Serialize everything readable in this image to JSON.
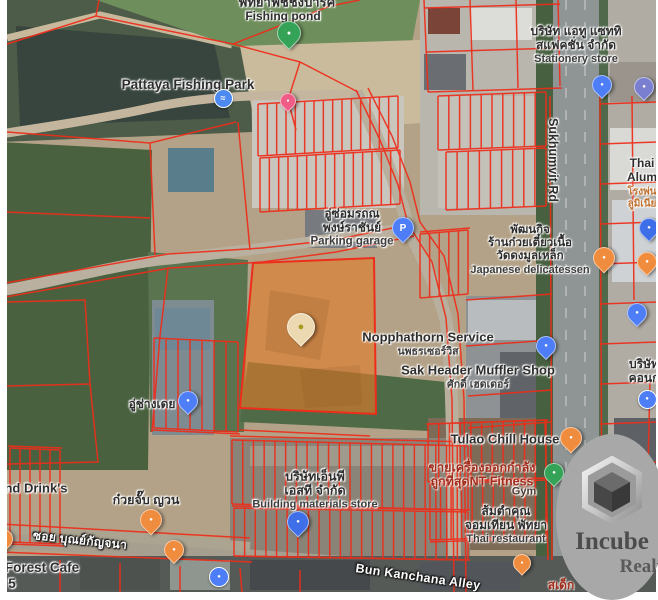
{
  "watermark": {
    "brand": "Incube",
    "division": "Realty"
  },
  "colors": {
    "cadastral_line": "#ee2d1a",
    "parcel_highlight": "#e07a29",
    "watermark_bg": "#a8a8a8",
    "poi_label": "#2e2e2e",
    "road_label": "#fdfdfd",
    "red_label": "#a02c1e"
  },
  "map": {
    "labels": [
      {
        "name": "fishing-park-thai",
        "x": 287,
        "y": 3,
        "style": "poi",
        "lines": [
          {
            "t": "พัทยาฟิชชิ่งปาร์ค",
            "s": 13
          }
        ]
      },
      {
        "name": "fishing-pond",
        "x": 283,
        "y": 17,
        "style": "poi",
        "lines": [
          {
            "t": "Fishing pond",
            "s": 12
          }
        ]
      },
      {
        "name": "pattaya-fishing-park",
        "x": 188,
        "y": 85,
        "style": "poi",
        "lines": [
          {
            "t": "Pattaya Fishing Park",
            "s": 13.5
          }
        ]
      },
      {
        "name": "stationery-store",
        "x": 576,
        "y": 45,
        "style": "poi",
        "lines": [
          {
            "t": "บริษัท แอทู แซททิ",
            "s": 12
          },
          {
            "t": "สแฟคชั่น จำกัด",
            "s": 12
          },
          {
            "t": "Stationery store",
            "s": 11,
            "c": "#3c3c3c"
          }
        ]
      },
      {
        "name": "sukhumvit-rd",
        "x": 553,
        "y": 160,
        "style": "poi",
        "rotate": 90,
        "lines": [
          {
            "t": "Sukhumvit Rd",
            "s": 12.5
          }
        ]
      },
      {
        "name": "thai-alum",
        "x": 642,
        "y": 171,
        "style": "poi",
        "lines": [
          {
            "t": "Thai",
            "s": 12
          },
          {
            "t": "Alum",
            "s": 12
          }
        ]
      },
      {
        "name": "thai-alum-sub",
        "x": 642,
        "y": 198,
        "style": "poi",
        "lines": [
          {
            "t": "โรงพ่น",
            "s": 10,
            "c": "#c0722f"
          },
          {
            "t": "ลูมิเนีย",
            "s": 10,
            "c": "#c0722f"
          }
        ]
      },
      {
        "name": "parking-garage",
        "x": 352,
        "y": 228,
        "style": "poi",
        "lines": [
          {
            "t": "อู่ซ่อมรถณ",
            "s": 12
          },
          {
            "t": "พงษ์ราชันย์",
            "s": 12
          },
          {
            "t": "Parking garage",
            "s": 11.5,
            "c": "#3c3c3c"
          }
        ]
      },
      {
        "name": "japanese-delicatessen",
        "x": 530,
        "y": 250,
        "style": "poi",
        "lines": [
          {
            "t": "พัฒนกิจ",
            "s": 11.5
          },
          {
            "t": "ร้านก๋วยเตี๋ยวเนื้อ",
            "s": 11.5
          },
          {
            "t": "วัดดงมูลเหล็ก",
            "s": 11.5
          },
          {
            "t": "Japanese delicatessen",
            "s": 11,
            "c": "#3c3c3c"
          }
        ]
      },
      {
        "name": "nopphathorn-service",
        "x": 428,
        "y": 344,
        "style": "poi",
        "lines": [
          {
            "t": "Nopphathorn Service",
            "s": 13
          },
          {
            "t": "นพธรเซอร์วิส",
            "s": 10.5,
            "c": "#3c3c3c"
          }
        ]
      },
      {
        "name": "sak-header-muffler-shop",
        "x": 478,
        "y": 377,
        "style": "poi",
        "lines": [
          {
            "t": "Sak Header Muffler Shop",
            "s": 13
          },
          {
            "t": "ศักดิ์ เฮดเดอร์",
            "s": 10.5,
            "c": "#3c3c3c"
          }
        ]
      },
      {
        "name": "u-chang-doei",
        "x": 152,
        "y": 405,
        "style": "poi",
        "lines": [
          {
            "t": "อู่ช่างเดย",
            "s": 12
          }
        ]
      },
      {
        "name": "tulao-chill-house",
        "x": 505,
        "y": 440,
        "style": "poi",
        "lines": [
          {
            "t": "Tulao Chill House",
            "s": 13
          }
        ]
      },
      {
        "name": "nt-fitness",
        "x": 482,
        "y": 475,
        "style": "red",
        "lines": [
          {
            "t": "ขายเครื่องออกกำลัง",
            "s": 12.5
          },
          {
            "t": "ถูกที่สุดNT Fitness",
            "s": 12.5
          }
        ]
      },
      {
        "name": "gym",
        "x": 524,
        "y": 492,
        "style": "poi",
        "lines": [
          {
            "t": "Gym",
            "s": 11,
            "c": "#4a3a32"
          }
        ]
      },
      {
        "name": "somtam-thai-restaurant",
        "x": 506,
        "y": 525,
        "style": "poi",
        "lines": [
          {
            "t": "ส้มตำคุณ",
            "s": 12
          },
          {
            "t": "จอมเทียน พัทยา",
            "s": 12
          },
          {
            "t": "Thai restaurant",
            "s": 11,
            "c": "#3c3c3c"
          }
        ]
      },
      {
        "name": "np-st-building-materials",
        "x": 315,
        "y": 490,
        "style": "poi",
        "lines": [
          {
            "t": "บริษัทเอ็นพี",
            "s": 12.5
          },
          {
            "t": "เอสที จำกัด",
            "s": 12.5
          },
          {
            "t": "Building materials store",
            "s": 11,
            "c": "#3c3c3c"
          }
        ]
      },
      {
        "name": "nd-drinks",
        "x": 36,
        "y": 489,
        "style": "poi",
        "lines": [
          {
            "t": "nd Drink's",
            "s": 13
          }
        ]
      },
      {
        "name": "kuai-jap-yuan",
        "x": 146,
        "y": 500,
        "style": "poi",
        "lines": [
          {
            "t": "ก๋วยจั๊บ ญวน",
            "s": 12.5
          }
        ]
      },
      {
        "name": "soi-bun-kanchana",
        "x": 80,
        "y": 541,
        "style": "road",
        "rotate": 6,
        "lines": [
          {
            "t": "ซอย บุณย์กัญจนา",
            "s": 12
          }
        ]
      },
      {
        "name": "forest-cafe",
        "x": 42,
        "y": 568,
        "style": "poi",
        "lines": [
          {
            "t": "Forest Cafe",
            "s": 13.5
          }
        ]
      },
      {
        "name": "forest-cafe-5",
        "x": 12,
        "y": 584,
        "style": "poi",
        "lines": [
          {
            "t": "5",
            "s": 13.5
          }
        ]
      },
      {
        "name": "bun-kanchana-alley",
        "x": 418,
        "y": 577,
        "style": "road",
        "rotate": 8,
        "lines": [
          {
            "t": "Bun Kanchana Alley",
            "s": 12.5
          }
        ]
      },
      {
        "name": "borisat-kon-partial",
        "x": 644,
        "y": 372,
        "style": "poi",
        "lines": [
          {
            "t": "บริษัท",
            "s": 12
          },
          {
            "t": "คอนก",
            "s": 12
          }
        ]
      },
      {
        "name": "sa-dek-partial",
        "x": 561,
        "y": 586,
        "style": "red",
        "lines": [
          {
            "t": "สเด็ก",
            "s": 12
          }
        ]
      }
    ],
    "pins": [
      {
        "name": "fishing-pond-pin",
        "kind": "drop",
        "x": 288,
        "y": 32,
        "size": 22,
        "color": "#34a257",
        "glyph": "●",
        "gs": 7
      },
      {
        "name": "park-pool-icon",
        "kind": "dot",
        "x": 222,
        "y": 97,
        "size": 17,
        "color": "#4d8af0",
        "glyph": "≈",
        "gs": 9
      },
      {
        "name": "park-entry-pin",
        "kind": "drop",
        "x": 287,
        "y": 100,
        "size": 14,
        "color": "#ef5c85",
        "glyph": "●",
        "gs": 5
      },
      {
        "name": "stationery-pin",
        "kind": "drop",
        "x": 601,
        "y": 84,
        "size": 18,
        "color": "#4d7ef7",
        "glyph": "●",
        "gs": 6
      },
      {
        "name": "fuel-station-pin",
        "kind": "drop",
        "x": 643,
        "y": 86,
        "size": 18,
        "color": "#7a7fd0",
        "glyph": "●",
        "gs": 6
      },
      {
        "name": "parking-garage-pin",
        "kind": "drop",
        "x": 402,
        "y": 227,
        "size": 20,
        "color": "#4d7ef7",
        "glyph": "P",
        "gs": 10
      },
      {
        "name": "thai-alum-pin",
        "kind": "drop",
        "x": 648,
        "y": 227,
        "size": 18,
        "color": "#3f6fe8",
        "glyph": "●",
        "gs": 6
      },
      {
        "name": "delicatessen-pin",
        "kind": "drop",
        "x": 603,
        "y": 257,
        "size": 20,
        "color": "#f08c3e",
        "glyph": "●",
        "gs": 6
      },
      {
        "name": "restaurant-pin-east",
        "kind": "drop",
        "x": 646,
        "y": 261,
        "size": 18,
        "color": "#f08c3e",
        "glyph": "●",
        "gs": 6
      },
      {
        "name": "subject-parcel-pin",
        "kind": "drop",
        "x": 300,
        "y": 326,
        "size": 26,
        "color": "#ecd9b2",
        "glyph": "●",
        "gc": "#a79a1e",
        "gs": 11
      },
      {
        "name": "sak-header-pin",
        "kind": "drop",
        "x": 545,
        "y": 345,
        "size": 18,
        "color": "#4d7ef7",
        "glyph": "●",
        "gs": 6
      },
      {
        "name": "shop-pin-east",
        "kind": "drop",
        "x": 636,
        "y": 312,
        "size": 18,
        "color": "#4d7ef7",
        "glyph": "●",
        "gs": 6
      },
      {
        "name": "poi-dot-east",
        "kind": "dot",
        "x": 646,
        "y": 398,
        "size": 17,
        "color": "#4d7ef7",
        "glyph": "●",
        "gs": 6
      },
      {
        "name": "u-chang-doei-pin",
        "kind": "drop",
        "x": 187,
        "y": 400,
        "size": 18,
        "color": "#4d7ef7",
        "glyph": "●",
        "gs": 6
      },
      {
        "name": "tulao-pin",
        "kind": "drop",
        "x": 570,
        "y": 437,
        "size": 20,
        "color": "#f08c3e",
        "glyph": "●",
        "gs": 6
      },
      {
        "name": "gym-pin",
        "kind": "drop",
        "x": 553,
        "y": 472,
        "size": 18,
        "color": "#34a257",
        "glyph": "●",
        "gs": 6
      },
      {
        "name": "building-materials-pin",
        "kind": "drop",
        "x": 297,
        "y": 521,
        "size": 20,
        "color": "#3f6fe8",
        "glyph": "●",
        "gs": 6
      },
      {
        "name": "kuai-jap-pin",
        "kind": "drop",
        "x": 150,
        "y": 519,
        "size": 20,
        "color": "#f08c3e",
        "glyph": "●",
        "gs": 6
      },
      {
        "name": "forest-cafe-pin",
        "kind": "drop",
        "x": 2,
        "y": 538,
        "size": 18,
        "color": "#f08c3e",
        "glyph": "●",
        "gs": 6
      },
      {
        "name": "alley-cafe-pin",
        "kind": "drop",
        "x": 173,
        "y": 549,
        "size": 18,
        "color": "#f08c3e",
        "glyph": "●",
        "gs": 6
      },
      {
        "name": "thai-restaurant-pin",
        "kind": "drop",
        "x": 521,
        "y": 562,
        "size": 16,
        "color": "#f08c3e",
        "glyph": "●",
        "gs": 5
      },
      {
        "name": "parking-dot-south",
        "kind": "dot",
        "x": 218,
        "y": 576,
        "size": 18,
        "color": "#4d7ef7",
        "glyph": "●",
        "gs": 6
      }
    ]
  }
}
